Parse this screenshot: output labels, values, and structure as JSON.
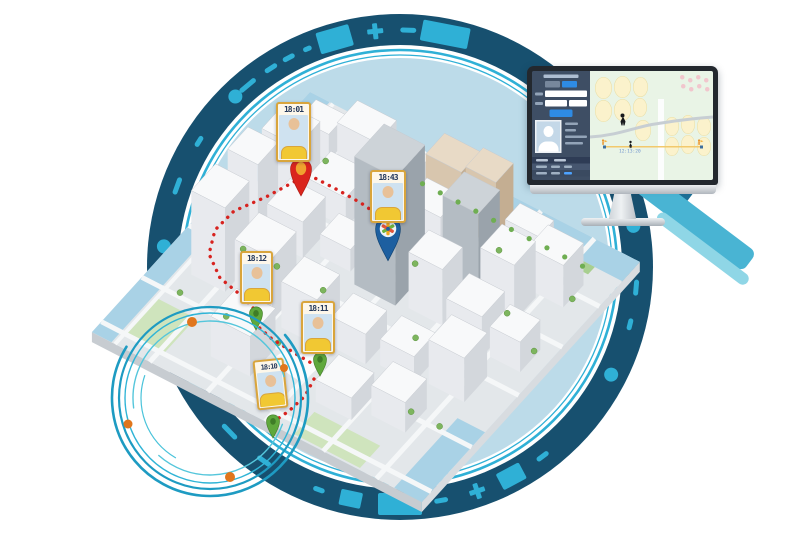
{
  "badges": [
    {
      "time": "18:01"
    },
    {
      "time": "18:43"
    },
    {
      "time": "18:12"
    },
    {
      "time": "18:11"
    },
    {
      "time": "18:10"
    }
  ],
  "monitor": {
    "timeline_time": "12:13:20"
  },
  "icons": {
    "red_pin": "location-pin",
    "blue_pin": "location-pin-compass",
    "green_pin": "location-pin-small",
    "person_marker": "walking-person-icon",
    "start_flag": "orange-runner-flag-icon",
    "end_flag": "orange-runner-flag-icon",
    "avatar": "person-silhouette"
  },
  "colors": {
    "ring_navy": "#17506f",
    "ring_accent": "#2fb0d6",
    "inner_circle": "#bcdbe9",
    "route_red": "#d7231f",
    "badge_border": "#d9a53c",
    "badge_time_text": "#24395c",
    "panel_dark": "#3e4e64",
    "accent_blue": "#2e8be4",
    "timeline_line": "#f2c96c",
    "orange_dot": "#e0761d",
    "water": "#a9d2e6"
  }
}
